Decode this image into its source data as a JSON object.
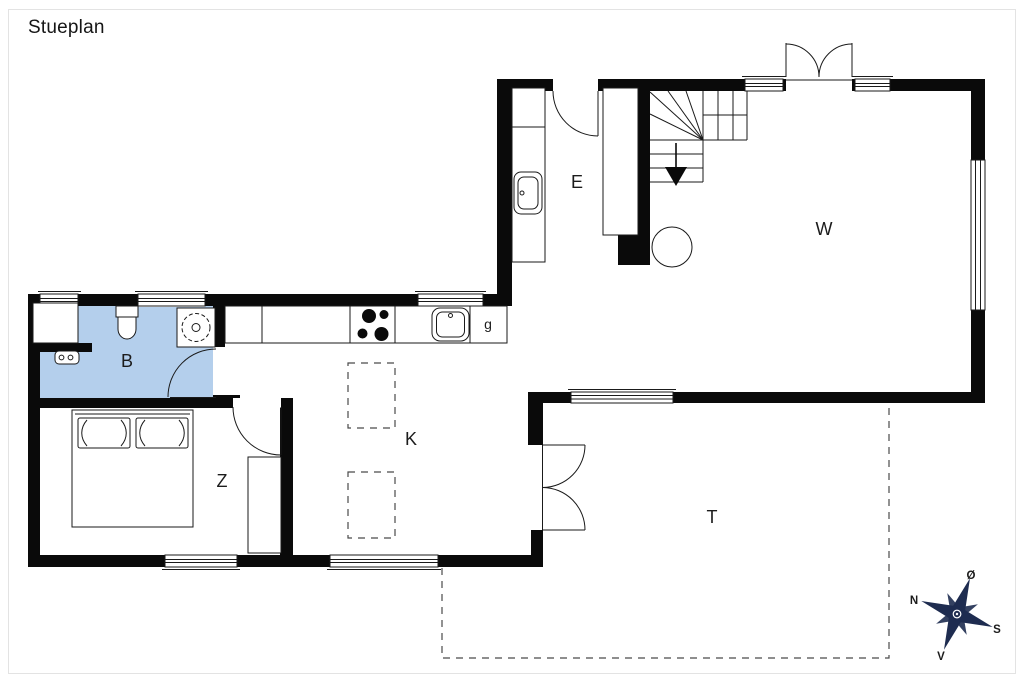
{
  "title": "Stueplan",
  "rooms": [
    {
      "name": "bathroom",
      "label": "B"
    },
    {
      "name": "bedroom",
      "label": "Z"
    },
    {
      "name": "kitchen-dining",
      "label": "K"
    },
    {
      "name": "entrance-hall",
      "label": "E"
    },
    {
      "name": "living-room",
      "label": "W"
    },
    {
      "name": "terrace",
      "label": "T"
    },
    {
      "name": "pantry",
      "label": "g"
    }
  ],
  "compass": {
    "north": "N",
    "east": "Ø",
    "south": "S",
    "west": "V"
  },
  "colors": {
    "wall": "#0a0a0a",
    "bathroom_fill": "#b4cfec",
    "compass": "#1e2c50",
    "frame": "#e3e3e3"
  }
}
